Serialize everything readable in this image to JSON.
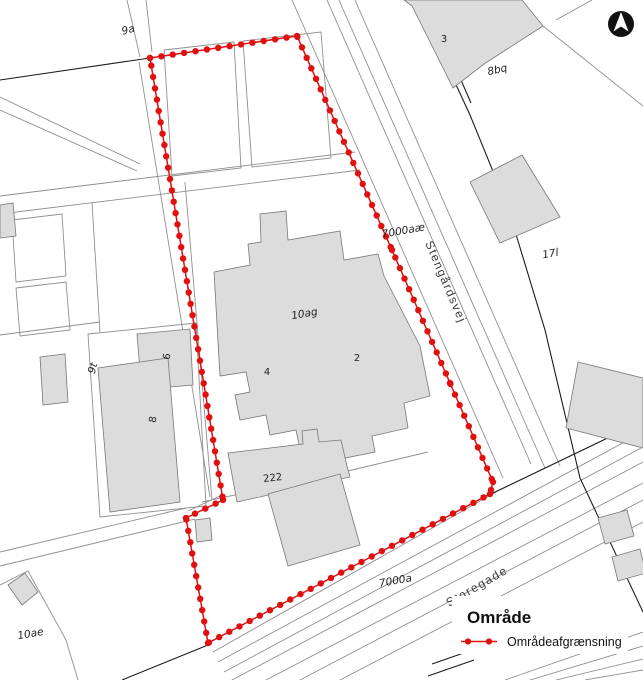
{
  "legend": {
    "title": "Område",
    "item_label": "Områdeafgrænsning"
  },
  "map": {
    "labels": [
      {
        "text": "9a",
        "kind": "parcel"
      },
      {
        "text": "3",
        "kind": "building-number"
      },
      {
        "text": "8bq",
        "kind": "parcel"
      },
      {
        "text": "7000aæ",
        "kind": "road-parcel"
      },
      {
        "text": "Stengårdsvej",
        "kind": "road-name"
      },
      {
        "text": "17l",
        "kind": "parcel"
      },
      {
        "text": "10ag",
        "kind": "parcel"
      },
      {
        "text": "2",
        "kind": "building-number"
      },
      {
        "text": "4",
        "kind": "building-number"
      },
      {
        "text": "6",
        "kind": "building-number"
      },
      {
        "text": "8",
        "kind": "building-number"
      },
      {
        "text": "9t",
        "kind": "parcel"
      },
      {
        "text": "222",
        "kind": "building-number"
      },
      {
        "text": "7000a",
        "kind": "road-parcel"
      },
      {
        "text": "Storegade",
        "kind": "road-name"
      },
      {
        "text": "10ae",
        "kind": "parcel"
      }
    ],
    "boundary": {
      "name": "Områdeafgrænsning",
      "color": "#e01010",
      "dot_spacing": 11.5,
      "dot_radius": 3.2,
      "closed": true,
      "points": [
        [
          150,
          58
        ],
        [
          297,
          36
        ],
        [
          392,
          250
        ],
        [
          450,
          383
        ],
        [
          493,
          482
        ],
        [
          490,
          494
        ],
        [
          208,
          643
        ],
        [
          186,
          518
        ],
        [
          223,
          500
        ]
      ]
    }
  },
  "colors": {
    "boundary_red": "#e01010",
    "building_fill": "#dcdcdc",
    "parcel_line_gray": "#8f8f8f",
    "black_line": "#1a1a1a"
  }
}
